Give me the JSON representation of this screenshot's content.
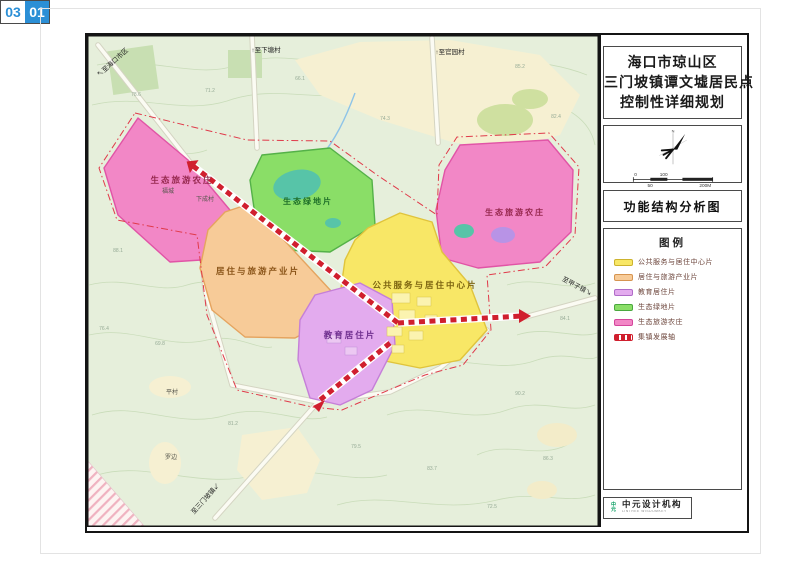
{
  "title_block": {
    "lines": [
      "海口市琼山区",
      "三门坡镇谭文墟居民点",
      "控制性详细规划"
    ]
  },
  "drawing_name": "功能结构分析图",
  "compass": {
    "north_label": "N",
    "scale_labels": [
      "0",
      "100",
      "50",
      "200M"
    ]
  },
  "legend": {
    "title": "图例",
    "items": [
      {
        "label": "公共服务与居住中心片",
        "fill": "#f8e766",
        "border": "#cdb32e",
        "type": "area"
      },
      {
        "label": "居住与旅游产业片",
        "fill": "#f7cb98",
        "border": "#d69450",
        "type": "area"
      },
      {
        "label": "教育居住片",
        "fill": "#e3abee",
        "border": "#b06cc8",
        "type": "area"
      },
      {
        "label": "生态绿地片",
        "fill": "#8ade67",
        "border": "#4aa83e",
        "type": "area"
      },
      {
        "label": "生态旅游农庄",
        "fill": "#f287c6",
        "border": "#d4469c",
        "type": "area"
      },
      {
        "label": "集镇发展轴",
        "fill": "#ffffff",
        "border": "#d01f2e",
        "type": "axis"
      }
    ]
  },
  "footer": {
    "publisher": "中元设计机构",
    "publisher_sub": "LINTREE WISDOMKEY",
    "publisher_mark": "中元",
    "sheet_total": "03",
    "sheet_no": "01"
  },
  "map": {
    "region_labels": [
      {
        "text": "生态旅游农庄",
        "x": 95,
        "y": 148,
        "color": "#96284e",
        "size": 8.5
      },
      {
        "text": "生态绿地片",
        "x": 221,
        "y": 169,
        "color": "#1e6e28",
        "size": 8
      },
      {
        "text": "生态旅游农庄",
        "x": 428,
        "y": 180,
        "color": "#96284e",
        "size": 8
      },
      {
        "text": "居住与旅游产业片",
        "x": 171,
        "y": 239,
        "color": "#8a5418",
        "size": 8.5
      },
      {
        "text": "公共服务与居住中心片",
        "x": 338,
        "y": 253,
        "color": "#7c6410",
        "size": 8.5
      },
      {
        "text": "教育居住片",
        "x": 263,
        "y": 303,
        "color": "#6e2e8e",
        "size": 8.5
      }
    ],
    "village_labels": [
      {
        "text": "福城",
        "x": 81,
        "y": 158
      },
      {
        "text": "下成村",
        "x": 118,
        "y": 166
      },
      {
        "text": "平村",
        "x": 85,
        "y": 359
      },
      {
        "text": "罗边",
        "x": 84,
        "y": 424
      }
    ],
    "road_labels": [
      {
        "text": "↖至海口市区",
        "x": 27,
        "y": 29,
        "rot": -42
      },
      {
        "text": "↑至下塘村",
        "x": 179,
        "y": 17,
        "rot": 0
      },
      {
        "text": "↑至官园村",
        "x": 363,
        "y": 19,
        "rot": 0
      },
      {
        "text": "至甲子镇↘",
        "x": 489,
        "y": 253,
        "rot": 28
      },
      {
        "text": "至三门坡镇↙",
        "x": 120,
        "y": 465,
        "rot": -48
      }
    ],
    "elevation_labels": [
      {
        "text": "78.6",
        "x": 49,
        "y": 61
      },
      {
        "text": "71.2",
        "x": 123,
        "y": 57
      },
      {
        "text": "66.1",
        "x": 213,
        "y": 45
      },
      {
        "text": "85.2",
        "x": 433,
        "y": 33
      },
      {
        "text": "82.4",
        "x": 469,
        "y": 83
      },
      {
        "text": "74.3",
        "x": 298,
        "y": 85
      },
      {
        "text": "88.1",
        "x": 31,
        "y": 217
      },
      {
        "text": "76.4",
        "x": 17,
        "y": 295
      },
      {
        "text": "69.8",
        "x": 73,
        "y": 310
      },
      {
        "text": "81.2",
        "x": 146,
        "y": 390
      },
      {
        "text": "79.5",
        "x": 269,
        "y": 413
      },
      {
        "text": "83.7",
        "x": 345,
        "y": 435
      },
      {
        "text": "90.2",
        "x": 433,
        "y": 360
      },
      {
        "text": "86.3",
        "x": 461,
        "y": 425
      },
      {
        "text": "72.5",
        "x": 405,
        "y": 473
      },
      {
        "text": "84.1",
        "x": 478,
        "y": 285
      }
    ]
  }
}
